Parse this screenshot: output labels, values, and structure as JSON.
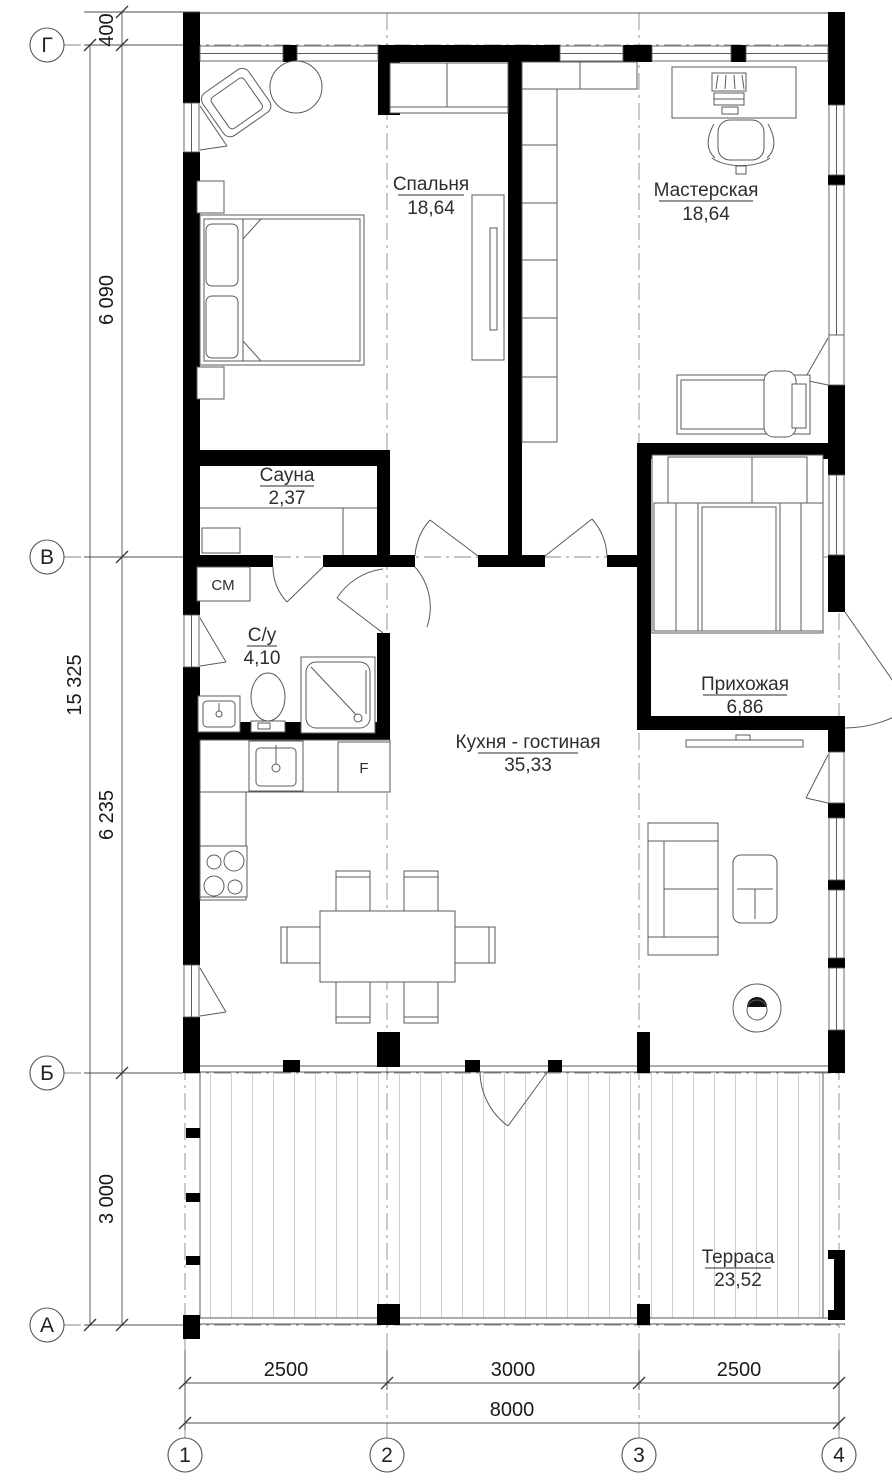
{
  "plan": {
    "rooms": [
      {
        "id": "bedroom",
        "name": "Спальня",
        "area": "18,64"
      },
      {
        "id": "workshop",
        "name": "Мастерская",
        "area": "18,64"
      },
      {
        "id": "sauna",
        "name": "Сауна",
        "area": "2,37"
      },
      {
        "id": "bathroom",
        "name": "С/у",
        "area": "4,10"
      },
      {
        "id": "hallway",
        "name": "Прихожая",
        "area": "6,86"
      },
      {
        "id": "kitchen_living",
        "name": "Кухня - гостиная",
        "area": "35,33"
      },
      {
        "id": "terrace",
        "name": "Терраса",
        "area": "23,52"
      }
    ],
    "appliances": {
      "washer": "СМ",
      "fridge": "F"
    },
    "grid_rows": [
      "Г",
      "В",
      "Б",
      "А"
    ],
    "grid_cols": [
      "1",
      "2",
      "3",
      "4"
    ],
    "dims_left": {
      "segments": [
        "400",
        "6 090",
        "6 235",
        "3 000"
      ],
      "total": "15 325"
    },
    "dims_bottom": {
      "segments": [
        "2500",
        "3000",
        "2500"
      ],
      "total": "8000"
    },
    "colors": {
      "wall": "#000000",
      "line": "#5b5b5b",
      "background": "#ffffff"
    }
  }
}
